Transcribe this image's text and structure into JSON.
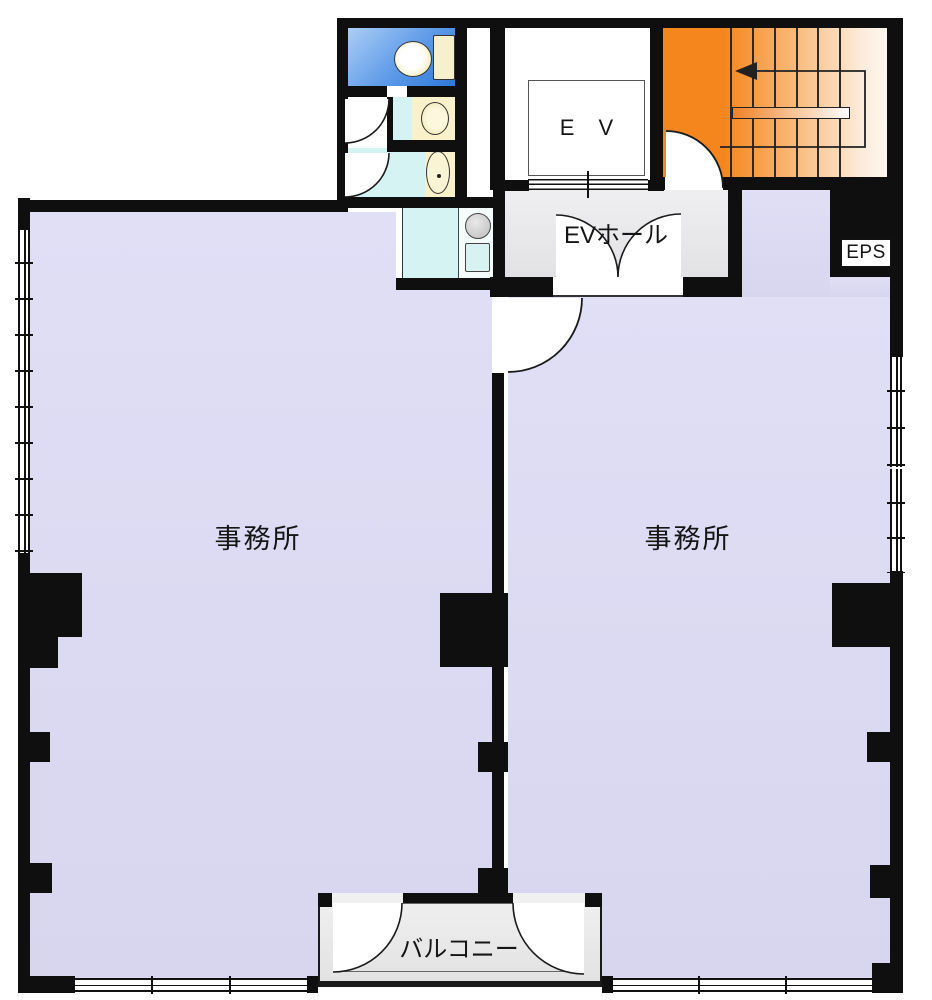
{
  "floorplan": {
    "kind": "building floor plan",
    "labels": {
      "office_left": "事務所",
      "office_right": "事務所",
      "ev_hall": "EVホール",
      "elevator": "E V",
      "eps": "EPS",
      "balcony": "バルコニー"
    },
    "colors": {
      "wall": "#0f0f0f",
      "office_floor": "#dcdaf2",
      "hall_floor": "#e8e8ea",
      "stairs_orange": "#f5861d",
      "wc_blue": "#2e78d8",
      "wet_area_cyan": "#d6f3f3",
      "fixture_cream": "#f8f1c9"
    },
    "fixtures": [
      "toilet",
      "toilet",
      "wash-basin",
      "kitchen-sink"
    ],
    "stair_direction_arrow": "left"
  }
}
